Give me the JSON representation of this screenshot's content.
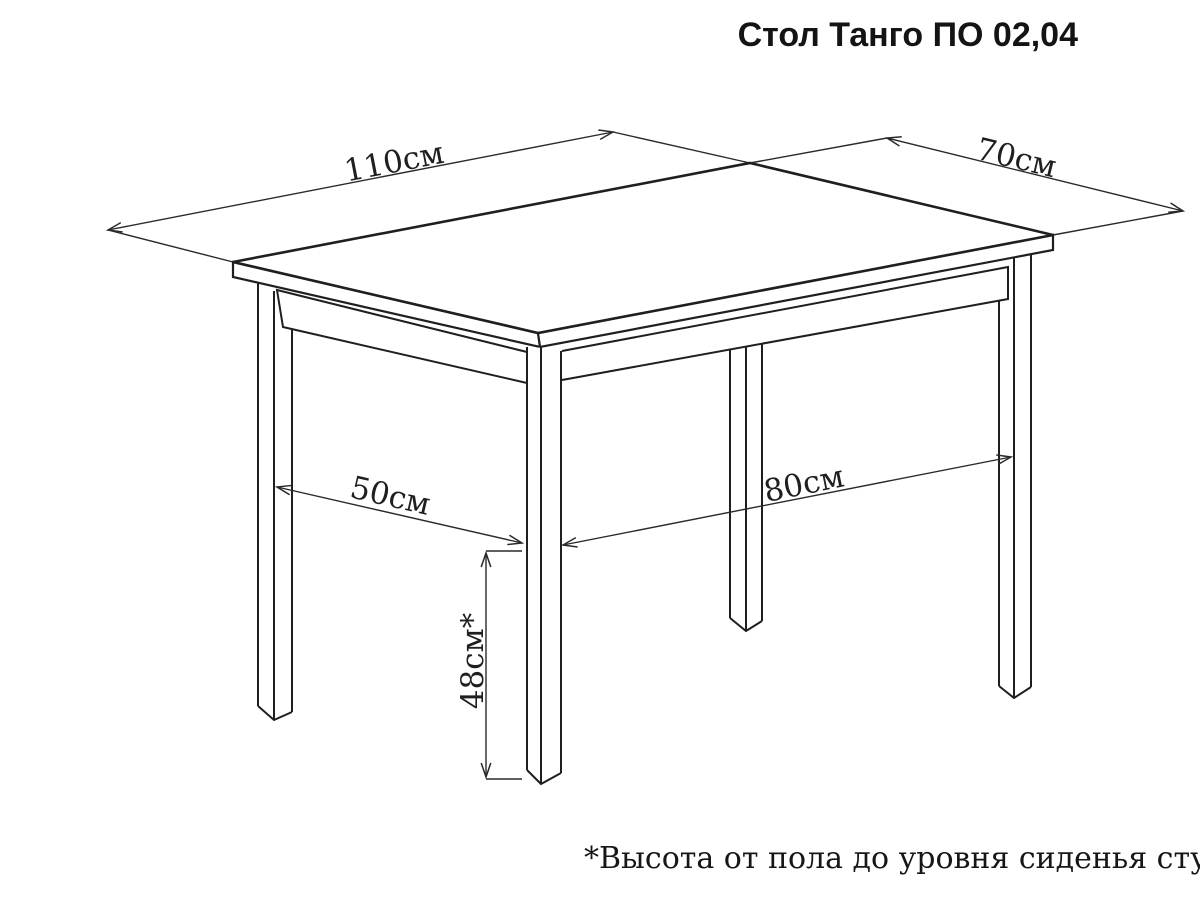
{
  "title": "Стол Танго ПО 02,04",
  "footnote": "*Высота от пола до уровня сиденья стула",
  "diagram": {
    "subject": "dining-table-line-drawing",
    "ink_color": "#1f1f1f",
    "background": "#ffffff",
    "dimensions": {
      "top_length": "110см",
      "top_depth": "70см",
      "leg_span_depth": "50см",
      "leg_span_length": "80см",
      "seat_height": "48см*"
    }
  }
}
